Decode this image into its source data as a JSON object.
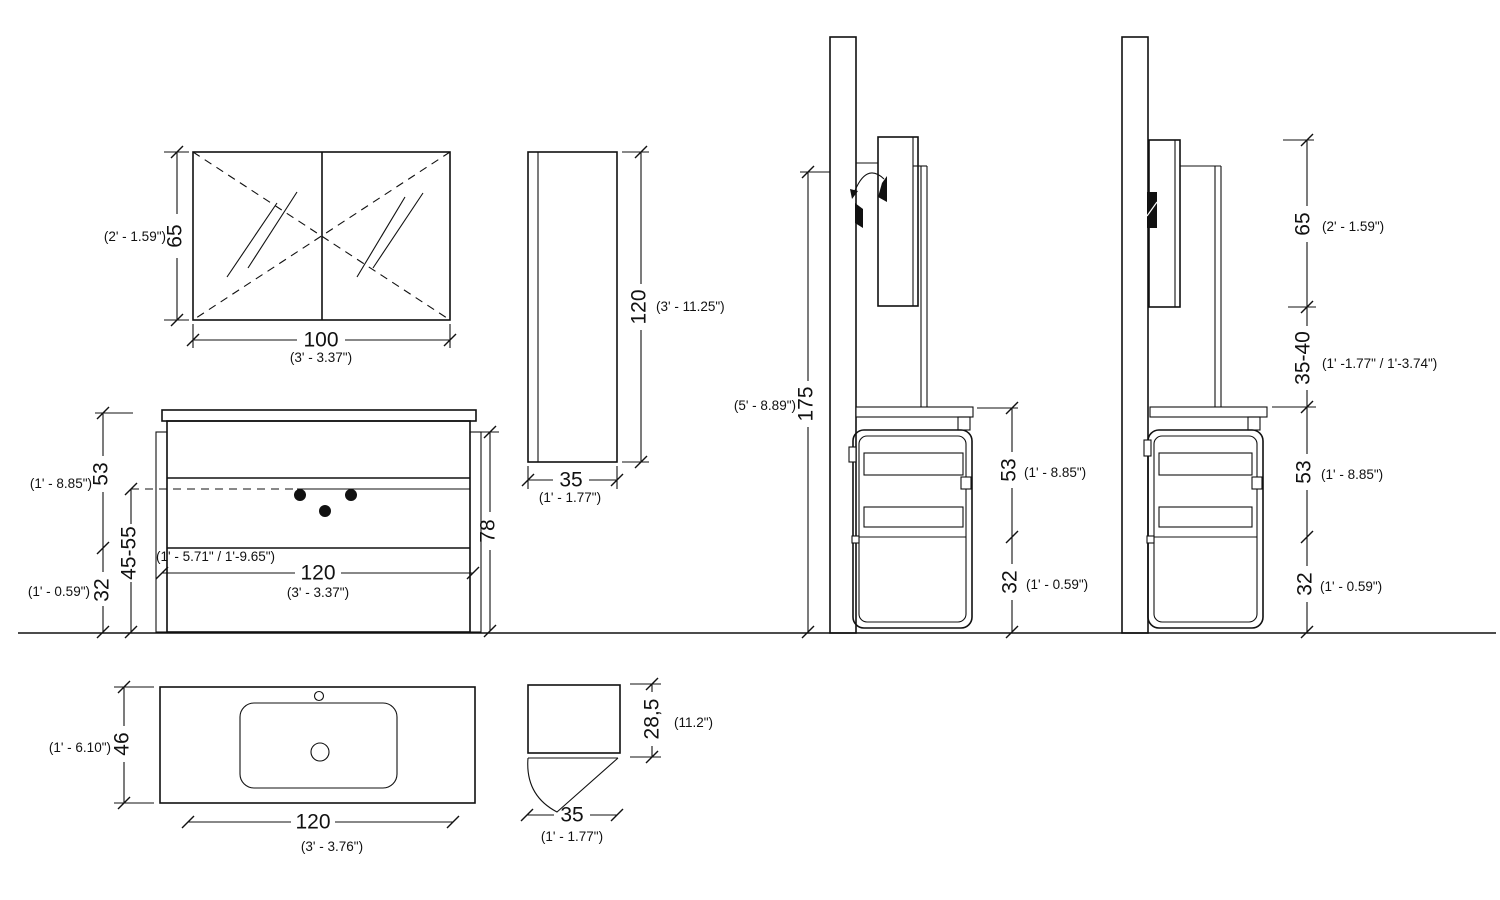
{
  "drawing": {
    "kind": "bathroom-vanity-technical-drawing",
    "line_color": "#111111",
    "background": "#ffffff",
    "dims": {
      "mirror_h": {
        "v": "65",
        "imp": "(2' - 1.59\")"
      },
      "mirror_w": {
        "v": "100",
        "imp": "(3' - 3.37\")"
      },
      "tall_h": {
        "v": "120",
        "imp": "(3' - 11.25\")"
      },
      "tall_w": {
        "v": "35",
        "imp": "(1' - 1.77\")"
      },
      "vanity_upper": {
        "v": "53",
        "imp": "(1' - 8.85\")"
      },
      "vanity_range": {
        "v": "45-55",
        "imp": "(1' - 5.71\" / 1'-9.65\")"
      },
      "vanity_lower": {
        "v": "32",
        "imp": "(1' - 0.59\")"
      },
      "vanity_body": {
        "v": "78"
      },
      "vanity_w": {
        "v": "120",
        "imp": "(3' - 3.37\")"
      },
      "side1_total": {
        "v": "175",
        "imp": "(5' - 8.89\")"
      },
      "side1_upper": {
        "v": "53",
        "imp": "(1' - 8.85\")"
      },
      "side1_lower": {
        "v": "32",
        "imp": "(1' - 0.59\")"
      },
      "side2_mirror": {
        "v": "65",
        "imp": "(2' - 1.59\")"
      },
      "side2_gap": {
        "v": "35-40",
        "imp": "(1' -1.77\" / 1'-3.74\")"
      },
      "side2_upper": {
        "v": "53",
        "imp": "(1' - 8.85\")"
      },
      "side2_lower": {
        "v": "32",
        "imp": "(1' - 0.59\")"
      },
      "sink_depth": {
        "v": "46",
        "imp": "(1' - 6.10\")"
      },
      "sink_w": {
        "v": "120",
        "imp": "(3' - 3.76\")"
      },
      "section_h": {
        "v": "28,5",
        "imp": "(11.2\")"
      },
      "section_w": {
        "v": "35",
        "imp": "(1' - 1.77\")"
      }
    }
  }
}
